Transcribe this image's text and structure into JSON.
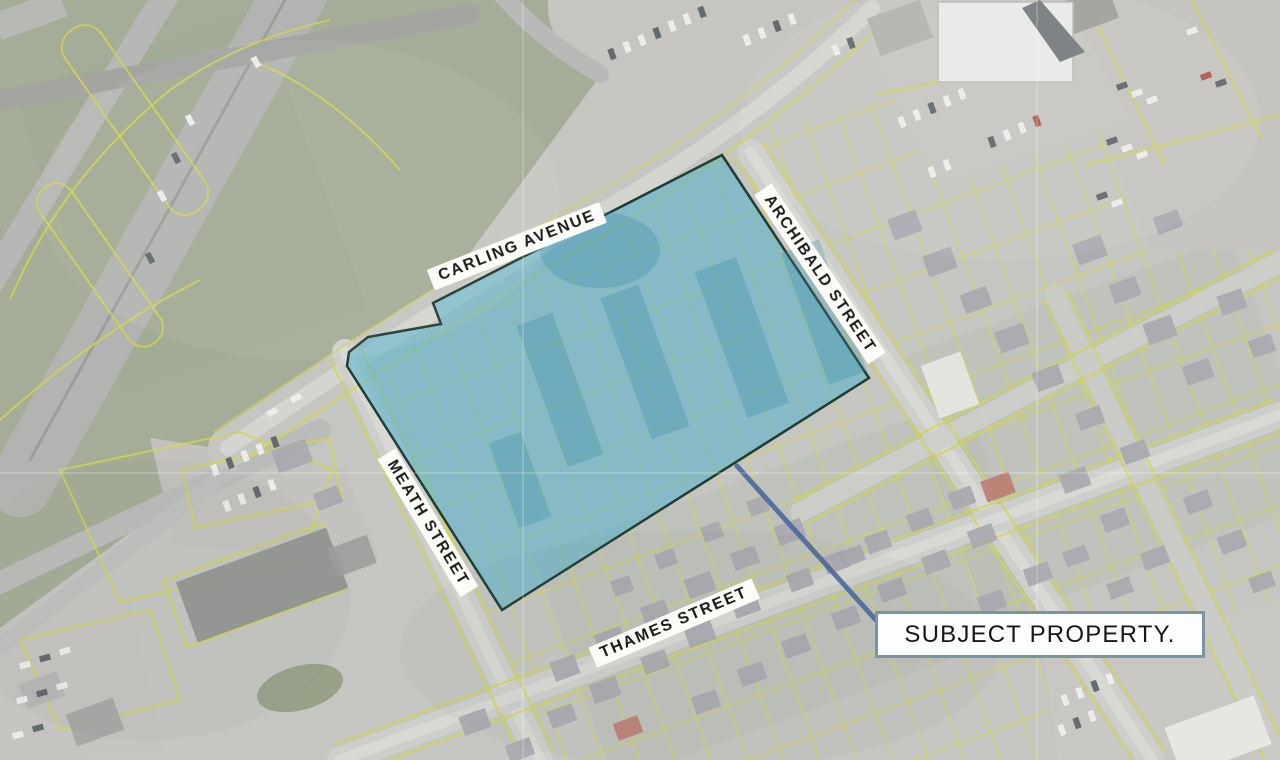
{
  "map": {
    "streets": {
      "carling": "CARLING AVENUE",
      "archibald": "ARCHIBALD STREET",
      "meath": "MEATH STREET",
      "thames": "THAMES STREET"
    },
    "callout": {
      "label": "SUBJECT PROPERTY."
    },
    "colors": {
      "base": "#c6c7c1",
      "grass": "#a3ac93",
      "road_major": "#b3b4b0",
      "road_minor": "#d0d1cc",
      "parcel_line": "#d4d73c",
      "subject_fill": "#43afcd",
      "subject_outline": "#15342b",
      "leader_line": "#3c5fa0",
      "callout_border": "#7b93a5",
      "callout_bg": "#fcfdfd",
      "label_bg": "#fbfbf8",
      "label_text": "#1b1b1b"
    }
  }
}
